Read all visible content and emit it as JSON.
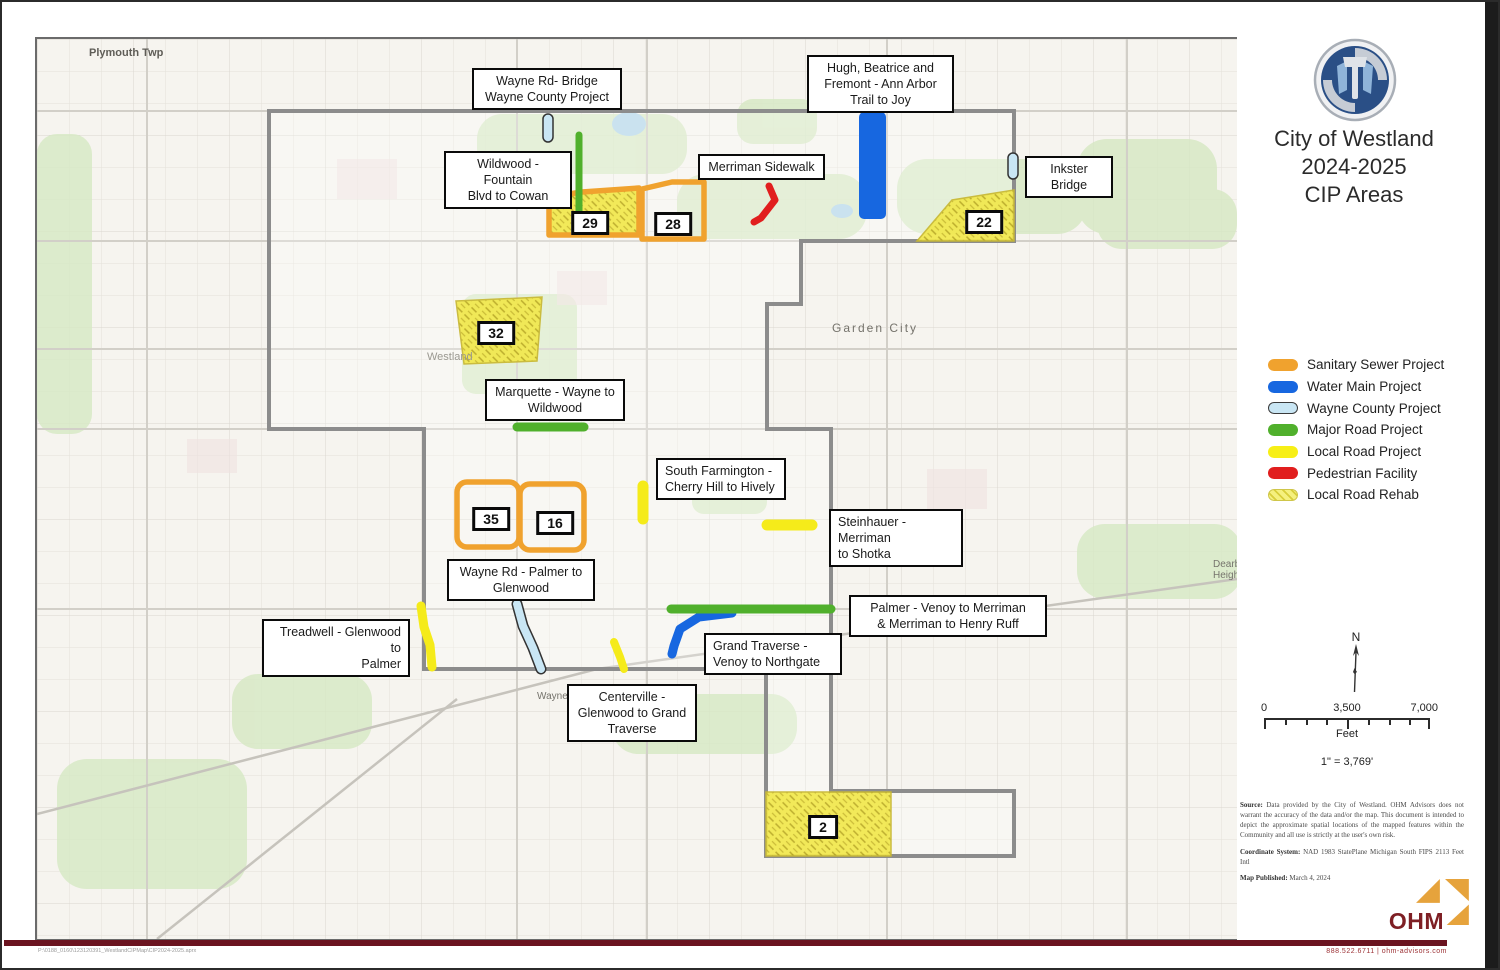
{
  "title": {
    "line1": "City of Westland",
    "line2": "2024-2025",
    "line3": "CIP Areas"
  },
  "legend": {
    "items": [
      {
        "label": "Sanitary Sewer Project",
        "color": "#F0A22E",
        "style": "solid"
      },
      {
        "label": "Water Main Project",
        "color": "#1767E0",
        "style": "solid"
      },
      {
        "label": "Wayne County Project",
        "color": "#C9E6F4",
        "style": "outline"
      },
      {
        "label": "Major Road Project",
        "color": "#50B02C",
        "style": "solid"
      },
      {
        "label": "Local Road Project",
        "color": "#F7EF16",
        "style": "solid"
      },
      {
        "label": "Pedestrian Facility",
        "color": "#E11E1E",
        "style": "solid"
      },
      {
        "label": "Local Road Rehab",
        "color": "#F5F07E",
        "style": "hatch"
      }
    ]
  },
  "map": {
    "project_labels": [
      {
        "text": "Wayne Rd- Bridge\nWayne County Project"
      },
      {
        "text": "Hugh, Beatrice and\nFremont - Ann Arbor\nTrail to Joy"
      },
      {
        "text": "Wildwood - Fountain\nBlvd to Cowan"
      },
      {
        "text": "Merriman Sidewalk"
      },
      {
        "text": "Inkster Bridge"
      },
      {
        "text": "Marquette - Wayne to\nWildwood"
      },
      {
        "text": "South Farmington -\nCherry Hill to Hively"
      },
      {
        "text": "Steinhauer - Merriman\nto Shotka"
      },
      {
        "text": "Wayne Rd - Palmer to\nGlenwood"
      },
      {
        "text": "Palmer - Venoy to Merriman\n& Merriman to Henry Ruff"
      },
      {
        "text": "Treadwell - Glenwood to\nPalmer"
      },
      {
        "text": "Grand Traverse -\nVenoy to Northgate"
      },
      {
        "text": "Centerville -\nGlenwood to Grand\nTraverse"
      }
    ],
    "area_badges": [
      {
        "num": "29"
      },
      {
        "num": "28"
      },
      {
        "num": "22"
      },
      {
        "num": "32"
      },
      {
        "num": "35"
      },
      {
        "num": "16"
      },
      {
        "num": "2"
      }
    ],
    "place_labels": [
      {
        "text": "Plymouth Twp"
      },
      {
        "text": "Garden City"
      },
      {
        "text": "Westland"
      },
      {
        "text": "Wayne"
      },
      {
        "text": "Dearborn\nHeights"
      }
    ]
  },
  "north_arrow": {
    "label": "N"
  },
  "scale_bar": {
    "tick0": "0",
    "tick_mid": "3,500",
    "tick_end": "7,000",
    "unit": "Feet",
    "ratio": "1\" = 3,769'"
  },
  "notes": {
    "source_label": "Source:",
    "source_text": " Data provided by the City of Westland. OHM Advisors does not warrant the accuracy of the data and/or the map. This document is intended to depict the approximate spatial locations of the mapped features within the Community and all use is strictly at the user's own risk.",
    "coord_label": "Coordinate System:",
    "coord_text": " NAD 1983 StatePlane Michigan South FIPS 2113 Feet Intl",
    "published_label": "Map Published:",
    "published_text": " March 4, 2024"
  },
  "footer": {
    "ohm_wordmark": "OHM",
    "contact": "888.522.6711   |   ohm-advisors.com",
    "path_text": "P:\\0188_0160\\123120391_WestlandCIPMap\\CIP2024-2025.aprx"
  }
}
